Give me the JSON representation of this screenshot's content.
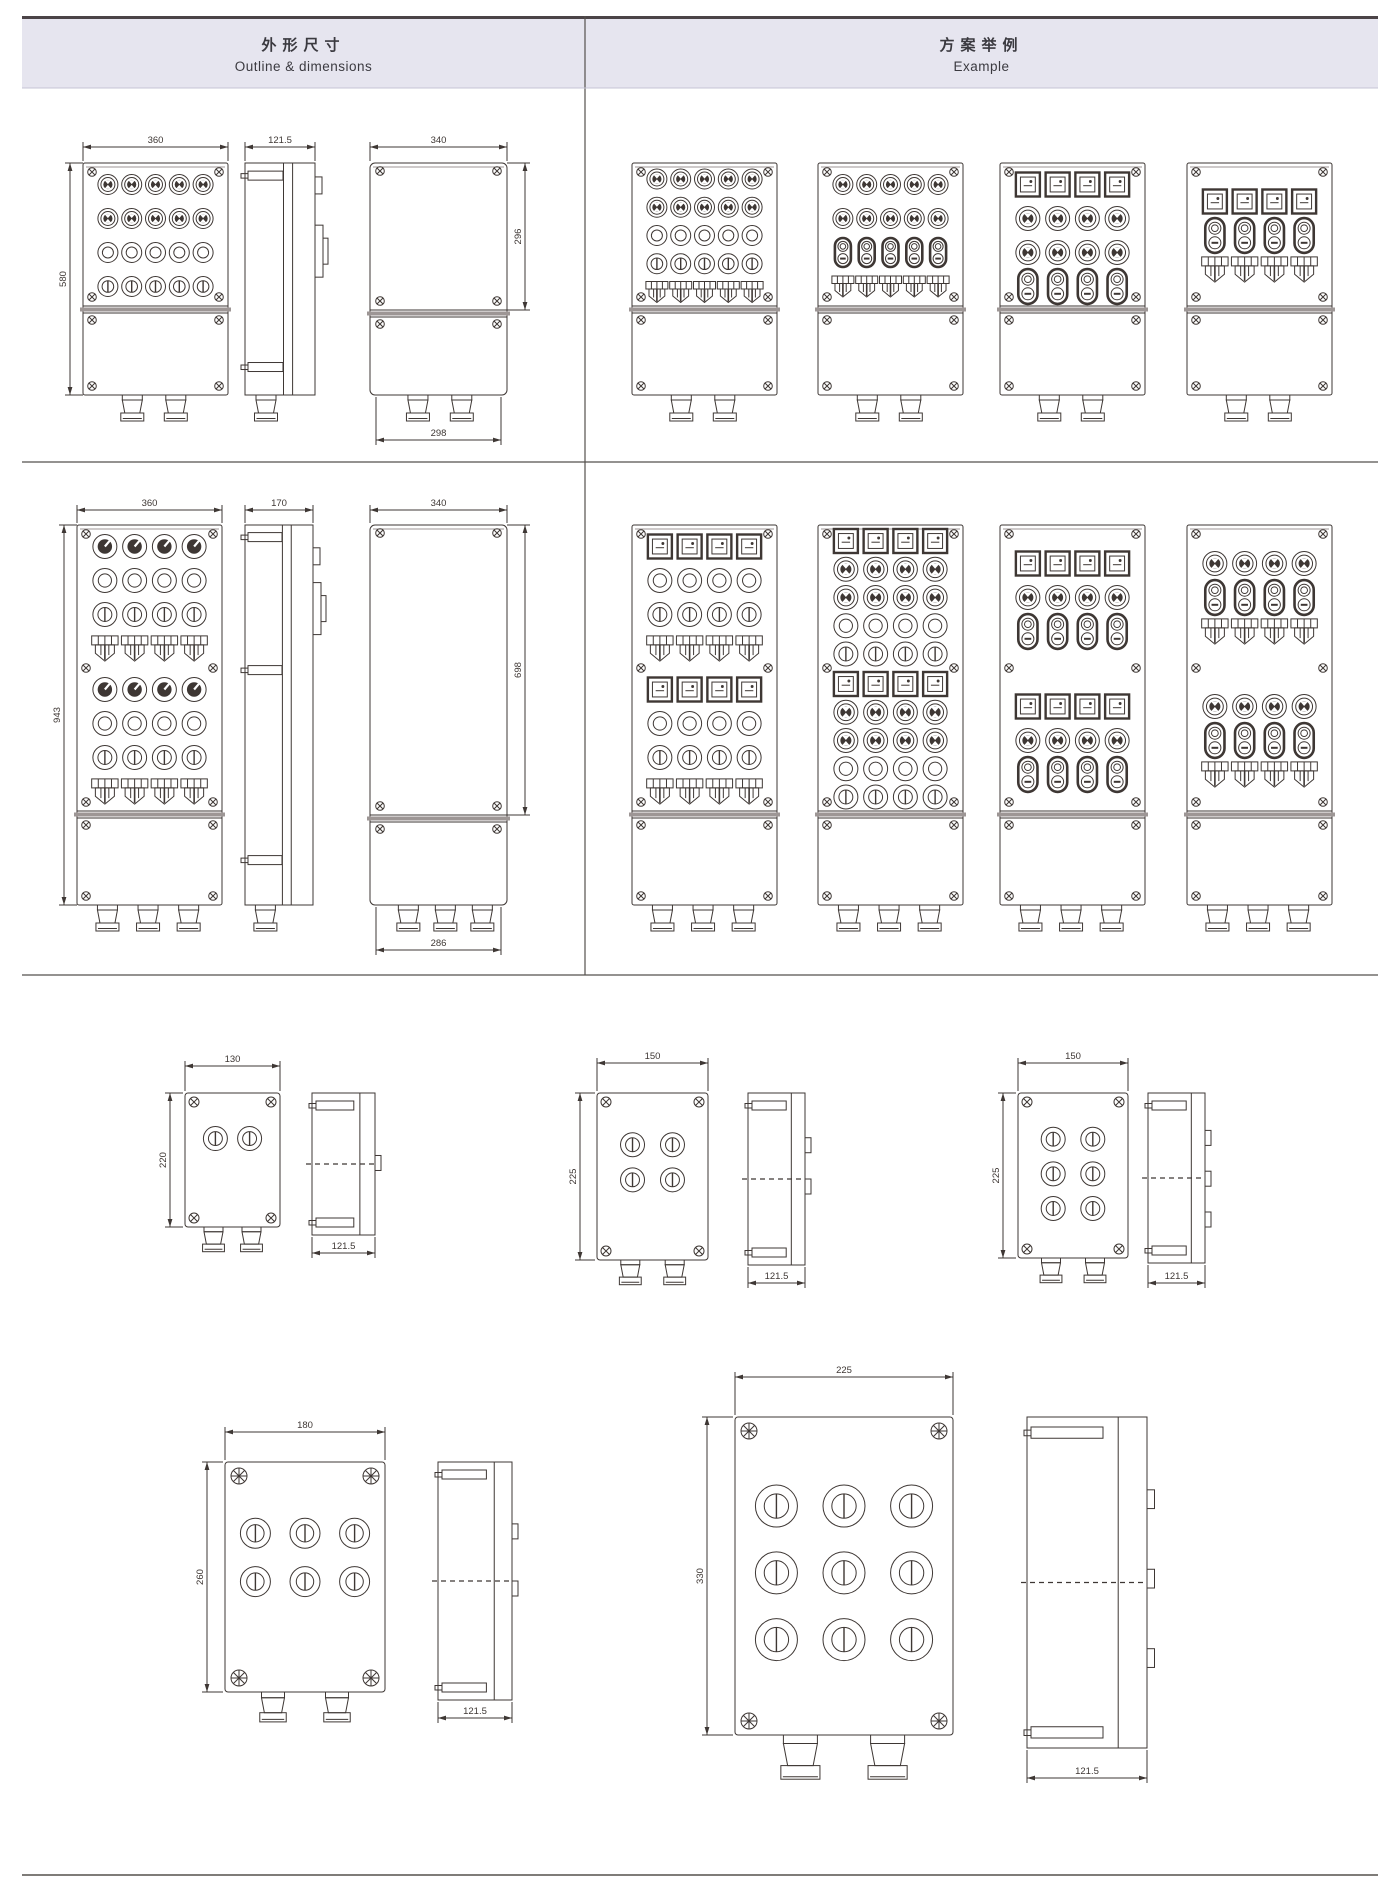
{
  "colors": {
    "line": "#3e3734",
    "gray": "#9d9695",
    "rule": "#55504d",
    "header_bg": "#e6e5ef",
    "text": "#3b3a40"
  },
  "header": {
    "outline": {
      "zh": "外形尺寸",
      "en": "Outline & dimensions"
    },
    "example": {
      "zh": "方案举例",
      "en": "Example"
    }
  },
  "row1": {
    "front": {
      "dim_top": "360",
      "dim_left": "580",
      "cols": 5,
      "rows": [
        "btn",
        "btn",
        "lamp",
        "lamp2"
      ],
      "glands": 2
    },
    "side": {
      "dim_top": "121.5",
      "glands": 1
    },
    "rear": {
      "dim_top": "340",
      "dim_right": "296",
      "dim_bottom": "298",
      "glands": 2
    },
    "examples": [
      {
        "cols": 5,
        "rows": [
          "btn",
          "btn",
          "lamp",
          "lamp2",
          "sw"
        ],
        "glands": 2
      },
      {
        "cols": 5,
        "rows": [
          "btn",
          "btn",
          "dbl",
          "sw"
        ],
        "glands": 2
      },
      {
        "cols": 4,
        "rows": [
          "meter",
          "btn",
          "btn",
          "dbl"
        ],
        "glands": 2
      },
      {
        "cols": 4,
        "rows": [
          "meter",
          "dbl",
          "sw"
        ],
        "glands": 2
      }
    ]
  },
  "row2": {
    "front": {
      "dim_top": "360",
      "dim_left": "943",
      "cols": 4,
      "rows": [
        "knob",
        "lamp",
        "lamp2",
        "sw"
      ],
      "sections": 2,
      "glands": 3
    },
    "side": {
      "dim_top": "170",
      "glands": 1
    },
    "rear": {
      "dim_top": "340",
      "dim_right": "698",
      "dim_bottom": "286",
      "glands": 3
    },
    "examples": [
      {
        "cols": 4,
        "rows": [
          "meter",
          "lamp",
          "lamp2",
          "sw"
        ],
        "sections": 2,
        "glands": 3
      },
      {
        "cols": 4,
        "rows": [
          "meter",
          "btn",
          "btn",
          "lamp",
          "lamp2"
        ],
        "sections": 2,
        "glands": 3
      },
      {
        "cols": 4,
        "rows": [
          "meter",
          "btn",
          "dbl"
        ],
        "sections": 2,
        "glands": 3
      },
      {
        "cols": 4,
        "rows": [
          "btn",
          "dbl",
          "sw"
        ],
        "sections": 2,
        "glands": 3
      }
    ]
  },
  "small_boxes": [
    {
      "dim_top": "130",
      "dim_left": "220",
      "side_dim": "121.5",
      "control": "pb",
      "cols": 2,
      "rows": 1,
      "glands": 2,
      "tabs": 1
    },
    {
      "dim_top": "150",
      "dim_left": "225",
      "side_dim": "121.5",
      "control": "pb",
      "cols": 2,
      "rows": 2,
      "glands": 2,
      "tabs": 2
    },
    {
      "dim_top": "150",
      "dim_left": "225",
      "side_dim": "121.5",
      "control": "pb",
      "cols": 2,
      "rows": 3,
      "glands": 2,
      "tabs": 3
    },
    {
      "dim_top": "180",
      "dim_left": "260",
      "side_dim": "121.5",
      "control": "pb",
      "cols": 3,
      "rows": 2,
      "glands": 2,
      "tabs": 2
    },
    {
      "dim_top": "225",
      "dim_left": "330",
      "side_dim": "121.5",
      "control": "pb",
      "cols": 3,
      "rows": 3,
      "glands": 2,
      "tabs": 3
    }
  ]
}
